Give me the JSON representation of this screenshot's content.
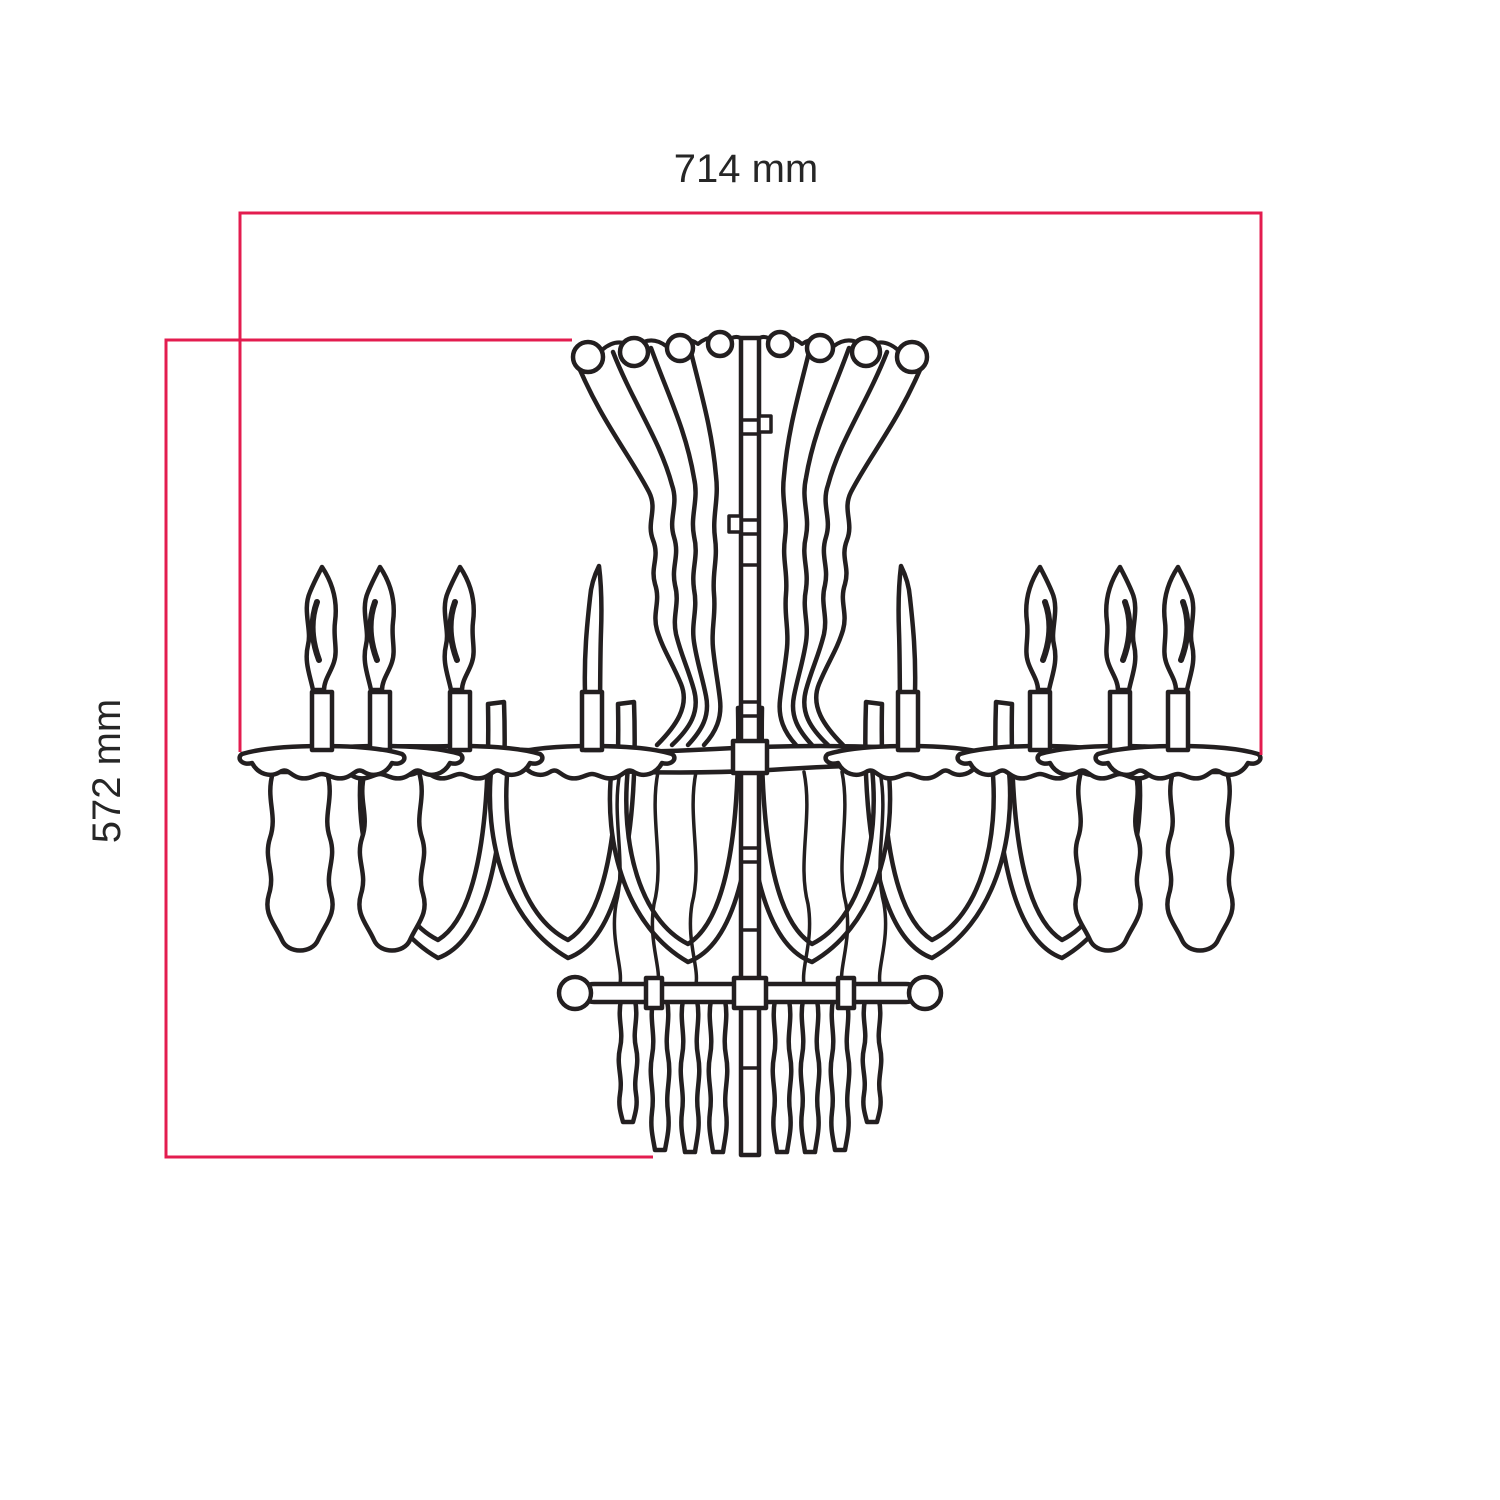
{
  "page": {
    "background_color": "#ffffff",
    "subject": "chandelier-dimension-diagram"
  },
  "colors": {
    "dimension_line": "#e31c4f",
    "drawing_line": "#231f20",
    "label_text": "#262626"
  },
  "dimension_labels": {
    "width": "714 mm",
    "height": "572 mm"
  },
  "dimension_values": {
    "width_mm": 714,
    "height_mm": 572,
    "unit": "mm"
  }
}
